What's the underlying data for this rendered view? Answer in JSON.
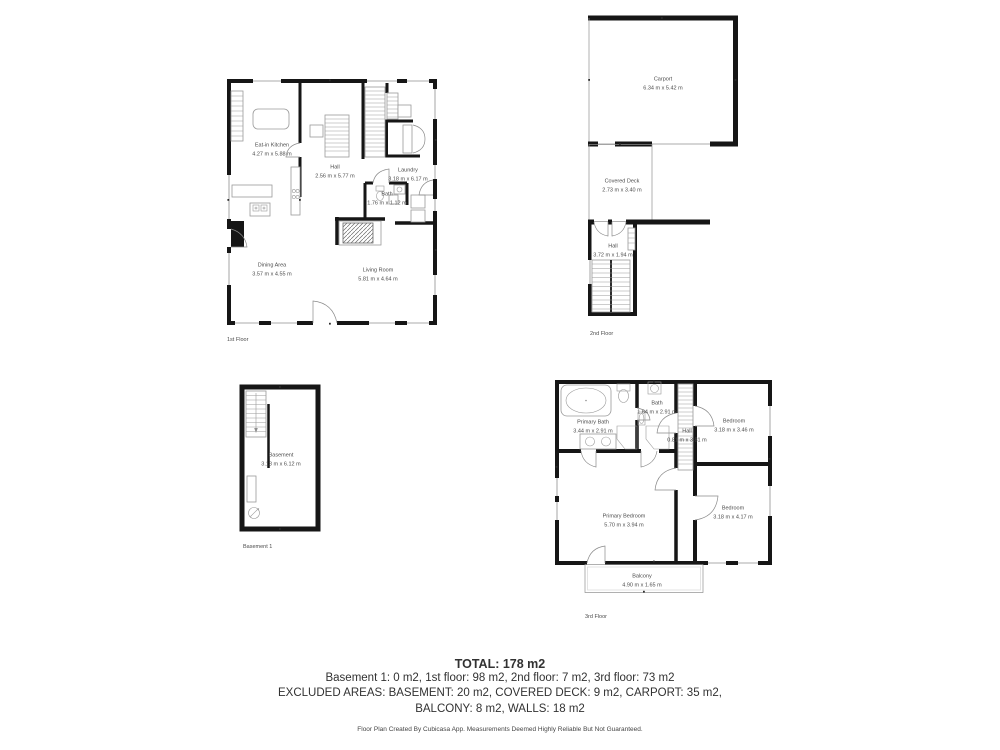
{
  "colors": {
    "wall": "#161616",
    "fixture_line": "#9a9a9a",
    "room_label_text": "#4c4c4c",
    "summary_text": "#323232"
  },
  "floors": {
    "first": {
      "caption": "1st Floor",
      "rooms": [
        {
          "name": "Eat-in Kitchen",
          "dims": "4.27 m x 5.88 m"
        },
        {
          "name": "Hall",
          "dims": "2.56 m x 5.77 m"
        },
        {
          "name": "Laundry",
          "dims": "3.18 m x 6.17 m"
        },
        {
          "name": "Bath",
          "dims": "1.76 m x 1.12 m"
        },
        {
          "name": "Dining Area",
          "dims": "3.57 m x 4.55 m"
        },
        {
          "name": "Living Room",
          "dims": "5.81 m x 4.64 m"
        }
      ]
    },
    "second": {
      "caption": "2nd Floor",
      "rooms": [
        {
          "name": "Carport",
          "dims": "6.34 m x 5.42 m"
        },
        {
          "name": "Covered Deck",
          "dims": "2.73 m x 3.40 m"
        },
        {
          "name": "Hall",
          "dims": "3.72 m x 1.94 m"
        }
      ]
    },
    "basement": {
      "caption": "Basement 1",
      "rooms": [
        {
          "name": "Basement",
          "dims": "3.18 m x 6.12 m"
        }
      ]
    },
    "third": {
      "caption": "3rd Floor",
      "rooms": [
        {
          "name": "Primary Bath",
          "dims": "3.44 m x 2.91 m"
        },
        {
          "name": "Bath",
          "dims": "1.64 m x 2.91 m"
        },
        {
          "name": "Hall",
          "dims": "0.81 m x 3.81 m"
        },
        {
          "name": "Bedroom",
          "dims": "3.18 m x 3.46 m"
        },
        {
          "name": "Primary Bedroom",
          "dims": "5.70 m x 3.94 m"
        },
        {
          "name": "Bedroom",
          "dims": "3.18 m x 4.17 m"
        },
        {
          "name": "Balcony",
          "dims": "4.90 m x 1.65 m"
        }
      ]
    }
  },
  "summary": {
    "total": "TOTAL: 178 m2",
    "floors_line": "Basement 1: 0 m2, 1st floor: 98 m2, 2nd floor: 7 m2, 3rd floor: 73 m2",
    "excluded_line1": "EXCLUDED AREAS: BASEMENT: 20 m2, COVERED DECK: 9 m2, CARPORT: 35 m2,",
    "excluded_line2": "BALCONY: 8 m2, WALLS: 18 m2",
    "disclaimer": "Floor Plan Created By Cubicasa App. Measurements Deemed Highly Reliable But Not Guaranteed."
  }
}
